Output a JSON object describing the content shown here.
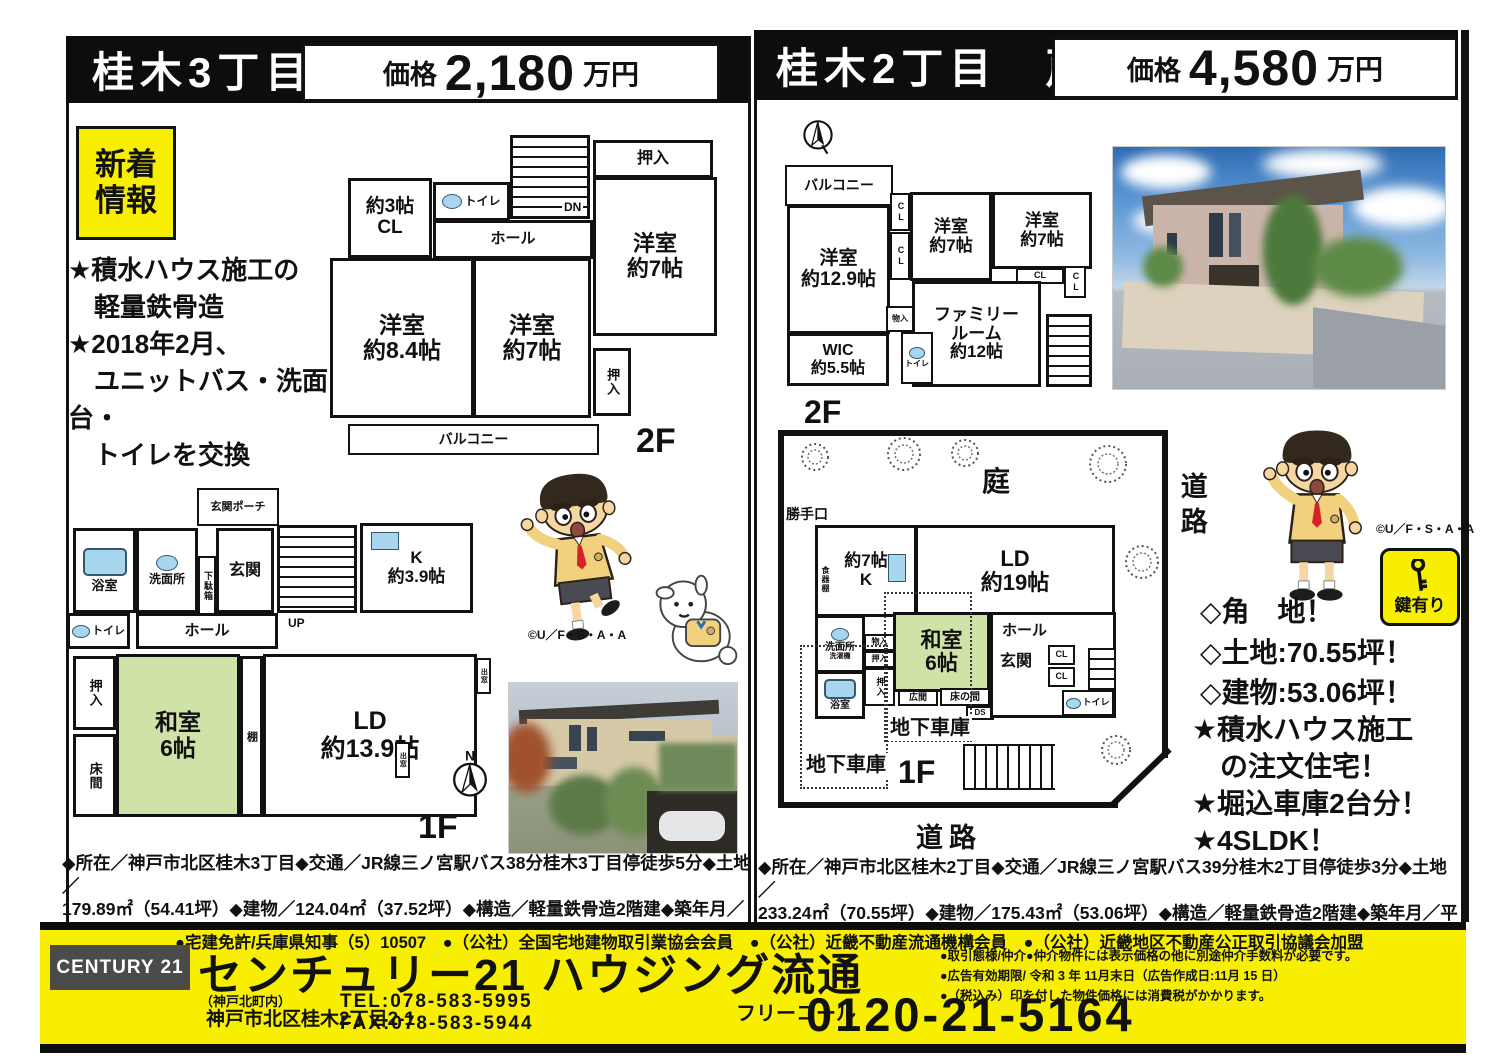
{
  "left": {
    "title": "桂木3丁目　戸建",
    "price_label": "価格",
    "price_value": "2,180",
    "price_unit": "万円",
    "badge": "新着\n情報",
    "highlights": "★積水ハウス施工の\n　軽量鉄骨造\n★2018年2月、\n　ユニットバス・洗面台・\n　トイレを交換",
    "floor2": {
      "cl3": "約3帖\nCL",
      "toilet": "トイレ",
      "dn": "DN",
      "hall": "ホール",
      "cl": "CL",
      "oshiire_top": "押入",
      "yoshitsu_r": "洋室\n約7帖",
      "yoshitsu_l": "洋室\n約8.4帖",
      "yoshitsu_m": "洋室\n約7帖",
      "oshiire_b": "押入",
      "balcony": "バルコニー",
      "label": "2F"
    },
    "floor1": {
      "porch": "玄関ポーチ",
      "bath": "浴室",
      "washroom": "洗面所",
      "getabako": "下駄箱",
      "genkan": "玄関",
      "up": "UP",
      "kitchen": "K\n約3.9帖",
      "toilet": "トイレ",
      "hall": "ホール",
      "oshiire": "押入",
      "washitsu": "和室\n6帖",
      "tokonoma": "床間",
      "tana": "棚",
      "ld": "LD\n約13.9帖",
      "demado1": "出窓",
      "demado2": "出窓",
      "label": "1F",
      "north": "N"
    },
    "copyright": "©U／F・S・A・A",
    "details": "◆所在／神戸市北区桂木3丁目◆交通／JR線三ノ宮駅バス38分桂木3丁目停徒歩5分◆土地／\n179.89㎡（54.41坪）◆建物／124.04㎡（37.52坪）◆構造／軽量鉄骨造2階建◆築年月／昭和63年\n11月◆私道負担／無◆引渡し／相談◆取引態様／仲介"
  },
  "right": {
    "title": "桂木2丁目　戸建",
    "price_label": "価格",
    "price_value": "4,580",
    "price_unit": "万円",
    "floor2": {
      "balcony": "バルコニー",
      "y129": "洋室\n約12.9帖",
      "cl1": "CL",
      "cl2": "CL",
      "y7a": "洋室\n約7帖",
      "y7b": "洋室\n約7帖",
      "cl3": "CL",
      "cl4": "CL",
      "family": "ファミリー\nルーム\n約12帖",
      "mono": "物入",
      "toilet": "トイレ",
      "wic": "WIC\n約5.5帖",
      "label": "2F"
    },
    "floor1": {
      "niwa": "庭",
      "katteguchi": "勝手口",
      "kitchen": "約7帖\nK",
      "shokkidana": "食器棚",
      "ld": "LD\n約19帖",
      "senmen": "洗面所",
      "sentaku": "洗濯機",
      "bath": "浴室",
      "mono": "物入",
      "oshiire1": "押入",
      "oshiire2": "押入",
      "washitsu": "和室\n6帖",
      "hiroma": "広間",
      "tokonoma": "床の間",
      "ds": "DS",
      "hall": "ホール",
      "genkan": "玄関",
      "cl1": "CL",
      "cl2": "CL",
      "toilet": "トイレ",
      "chika1": "地下車庫",
      "chika2": "地下車庫",
      "label": "1F"
    },
    "road_right": "道路",
    "road_bottom": "道路",
    "key_badge": "鍵有り",
    "copyright": "©U／F・S・A・A",
    "selling_diamond": "◇角　地！\n◇土地:70.55坪！\n◇建物:53.06坪！",
    "selling_star": "★積水ハウス施工\n　の注文住宅！\n★堀込車庫2台分！\n★4SLDK！",
    "details": "◆所在／神戸市北区桂木2丁目◆交通／JR線三ノ宮駅バス39分桂木2丁目停徒歩3分◆土地／\n233.24㎡（70.55坪）◆建物／175.43㎡（53.06坪）◆構造／軽量鉄骨造2階建◆築年月／平成14年\n11月◆私道負担／無◆引渡し／相談◆取引態様／仲介"
  },
  "footer": {
    "memberships": "●宅建免許/兵庫県知事（5）10507　●（公社）全国宅地建物取引業協会会員　●（公社）近畿不動産流通機構会員　●（公社）近畿地区不動産公正取引協議会加盟",
    "brand": "CENTURY 21",
    "company": "センチュリー21 ハウジング流通",
    "office_note": "（神戸北町内）",
    "address": "神戸市北区桂木2丁目2-1",
    "tel": "TEL:078-583-5995",
    "fax": "FAX:078-583-5944",
    "disclaimers": "●取引態様/仲介●仲介物件には表示価格の他に別途仲介手数料が必要です。\n●広告有効期限/ 令和 3 年 11月末日（広告作成日:11月 15 日）\n●（税込み）印を付した物件価格には消費税がかかります。",
    "freecall_label": "フリーコール",
    "freecall_number": "0120-21-5164"
  },
  "colors": {
    "flyer_yellow": "#f7ee00",
    "tatami_green": "#cfe3a8",
    "fixture_blue": "#a9d6ef",
    "ink_black": "#0d0d0d",
    "brand_gray": "#4b4b4b"
  }
}
